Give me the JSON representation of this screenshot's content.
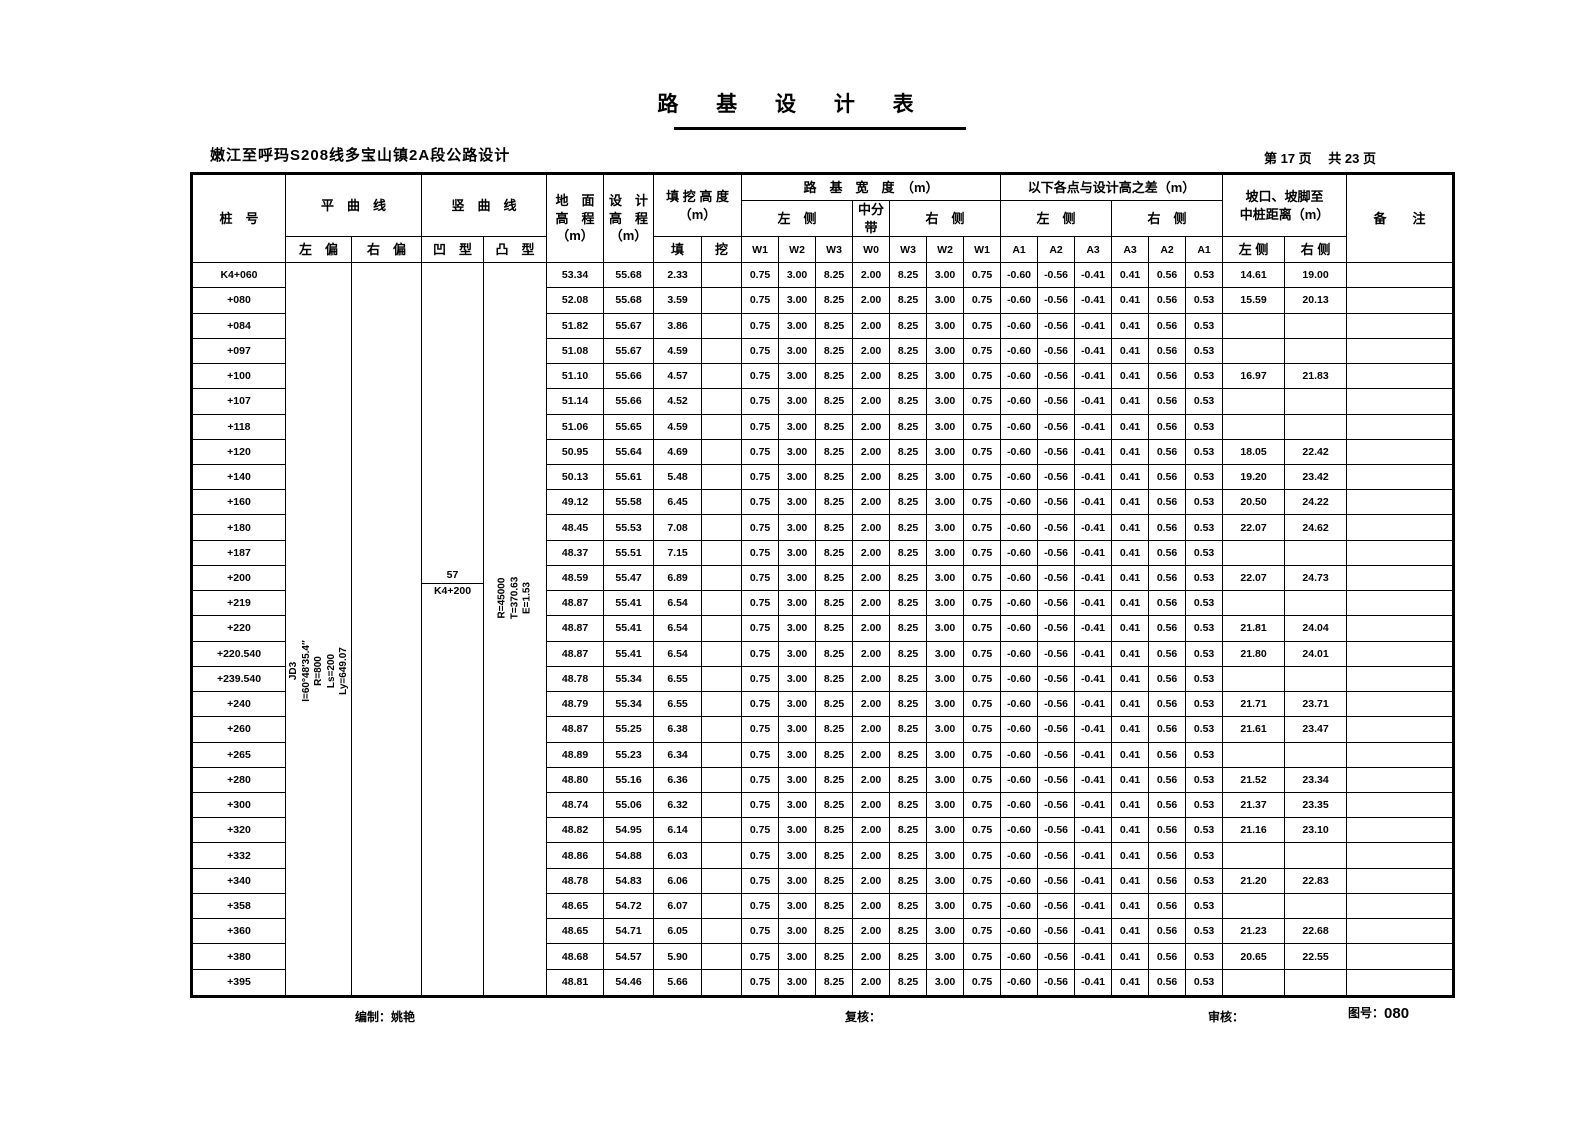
{
  "title": "路 基 设 计 表",
  "subtitle": "嫩江至呼玛S208线多宝山镇2A段公路设计",
  "page_info": "第 17 页　 共 23 页",
  "colors": {
    "line": "#000000",
    "background": "#ffffff"
  },
  "header": {
    "stake": "桩　号",
    "hcurve": {
      "title": "平　曲　线",
      "left": "左　偏",
      "right": "右　偏"
    },
    "vcurve": {
      "title": "竖　曲　线",
      "concave": "凹　型",
      "convex": "凸　型"
    },
    "ground": {
      "l1": "地　面",
      "l2": "高　程",
      "l3": "（m）"
    },
    "design": {
      "l1": "设　计",
      "l2": "高　程",
      "l3": "（m）"
    },
    "cutfill": {
      "title": "填 挖 高 度",
      "unit": "（m）",
      "fill": "填",
      "cut": "挖"
    },
    "width": {
      "title": "路　基　宽　度　（m）",
      "left": "左　侧",
      "median": "中分带",
      "right": "右　侧",
      "cols": [
        "W1",
        "W2",
        "W3",
        "W0",
        "W3",
        "W2",
        "W1"
      ]
    },
    "diff": {
      "title": "以下各点与设计高之差（m）",
      "left": "左　侧",
      "right": "右　侧",
      "cols": [
        "A1",
        "A2",
        "A3",
        "A3",
        "A2",
        "A1"
      ]
    },
    "slope": {
      "l1": "坡口、坡脚至",
      "l2": "中桩距离（m）",
      "left": "左 侧",
      "right": "右 侧"
    },
    "remark": "备　　注"
  },
  "annotations": {
    "h_curve_left": [
      "JD3",
      "I=60°48′35.4″",
      "R=800",
      "Ls=200",
      "Ly=649.07"
    ],
    "v_curve_concave": {
      "top": "57",
      "bottom": "K4+200"
    },
    "v_curve_convex": [
      "R=45000",
      "T=370.63",
      "E=1.53"
    ]
  },
  "constants": {
    "w_values": [
      "0.75",
      "3.00",
      "8.25",
      "2.00",
      "8.25",
      "3.00",
      "0.75"
    ],
    "a_values": [
      "-0.60",
      "-0.56",
      "-0.41",
      "0.41",
      "0.56",
      "0.53"
    ]
  },
  "rows": [
    {
      "stake": "K4+060",
      "ground": "53.34",
      "design": "55.68",
      "fill": "2.33",
      "cut": "",
      "dist_left": "14.61",
      "dist_right": "19.00"
    },
    {
      "stake": "+080",
      "ground": "52.08",
      "design": "55.68",
      "fill": "3.59",
      "cut": "",
      "dist_left": "15.59",
      "dist_right": "20.13"
    },
    {
      "stake": "+084",
      "ground": "51.82",
      "design": "55.67",
      "fill": "3.86",
      "cut": "",
      "dist_left": "",
      "dist_right": ""
    },
    {
      "stake": "+097",
      "ground": "51.08",
      "design": "55.67",
      "fill": "4.59",
      "cut": "",
      "dist_left": "",
      "dist_right": ""
    },
    {
      "stake": "+100",
      "ground": "51.10",
      "design": "55.66",
      "fill": "4.57",
      "cut": "",
      "dist_left": "16.97",
      "dist_right": "21.83"
    },
    {
      "stake": "+107",
      "ground": "51.14",
      "design": "55.66",
      "fill": "4.52",
      "cut": "",
      "dist_left": "",
      "dist_right": ""
    },
    {
      "stake": "+118",
      "ground": "51.06",
      "design": "55.65",
      "fill": "4.59",
      "cut": "",
      "dist_left": "",
      "dist_right": ""
    },
    {
      "stake": "+120",
      "ground": "50.95",
      "design": "55.64",
      "fill": "4.69",
      "cut": "",
      "dist_left": "18.05",
      "dist_right": "22.42"
    },
    {
      "stake": "+140",
      "ground": "50.13",
      "design": "55.61",
      "fill": "5.48",
      "cut": "",
      "dist_left": "19.20",
      "dist_right": "23.42"
    },
    {
      "stake": "+160",
      "ground": "49.12",
      "design": "55.58",
      "fill": "6.45",
      "cut": "",
      "dist_left": "20.50",
      "dist_right": "24.22"
    },
    {
      "stake": "+180",
      "ground": "48.45",
      "design": "55.53",
      "fill": "7.08",
      "cut": "",
      "dist_left": "22.07",
      "dist_right": "24.62"
    },
    {
      "stake": "+187",
      "ground": "48.37",
      "design": "55.51",
      "fill": "7.15",
      "cut": "",
      "dist_left": "",
      "dist_right": ""
    },
    {
      "stake": "+200",
      "ground": "48.59",
      "design": "55.47",
      "fill": "6.89",
      "cut": "",
      "dist_left": "22.07",
      "dist_right": "24.73"
    },
    {
      "stake": "+219",
      "ground": "48.87",
      "design": "55.41",
      "fill": "6.54",
      "cut": "",
      "dist_left": "",
      "dist_right": ""
    },
    {
      "stake": "+220",
      "ground": "48.87",
      "design": "55.41",
      "fill": "6.54",
      "cut": "",
      "dist_left": "21.81",
      "dist_right": "24.04"
    },
    {
      "stake": "+220.540",
      "ground": "48.87",
      "design": "55.41",
      "fill": "6.54",
      "cut": "",
      "dist_left": "21.80",
      "dist_right": "24.01"
    },
    {
      "stake": "+239.540",
      "ground": "48.78",
      "design": "55.34",
      "fill": "6.55",
      "cut": "",
      "dist_left": "",
      "dist_right": ""
    },
    {
      "stake": "+240",
      "ground": "48.79",
      "design": "55.34",
      "fill": "6.55",
      "cut": "",
      "dist_left": "21.71",
      "dist_right": "23.71"
    },
    {
      "stake": "+260",
      "ground": "48.87",
      "design": "55.25",
      "fill": "6.38",
      "cut": "",
      "dist_left": "21.61",
      "dist_right": "23.47"
    },
    {
      "stake": "+265",
      "ground": "48.89",
      "design": "55.23",
      "fill": "6.34",
      "cut": "",
      "dist_left": "",
      "dist_right": ""
    },
    {
      "stake": "+280",
      "ground": "48.80",
      "design": "55.16",
      "fill": "6.36",
      "cut": "",
      "dist_left": "21.52",
      "dist_right": "23.34"
    },
    {
      "stake": "+300",
      "ground": "48.74",
      "design": "55.06",
      "fill": "6.32",
      "cut": "",
      "dist_left": "21.37",
      "dist_right": "23.35"
    },
    {
      "stake": "+320",
      "ground": "48.82",
      "design": "54.95",
      "fill": "6.14",
      "cut": "",
      "dist_left": "21.16",
      "dist_right": "23.10"
    },
    {
      "stake": "+332",
      "ground": "48.86",
      "design": "54.88",
      "fill": "6.03",
      "cut": "",
      "dist_left": "",
      "dist_right": ""
    },
    {
      "stake": "+340",
      "ground": "48.78",
      "design": "54.83",
      "fill": "6.06",
      "cut": "",
      "dist_left": "21.20",
      "dist_right": "22.83"
    },
    {
      "stake": "+358",
      "ground": "48.65",
      "design": "54.72",
      "fill": "6.07",
      "cut": "",
      "dist_left": "",
      "dist_right": ""
    },
    {
      "stake": "+360",
      "ground": "48.65",
      "design": "54.71",
      "fill": "6.05",
      "cut": "",
      "dist_left": "21.23",
      "dist_right": "22.68"
    },
    {
      "stake": "+380",
      "ground": "48.68",
      "design": "54.57",
      "fill": "5.90",
      "cut": "",
      "dist_left": "20.65",
      "dist_right": "22.55"
    },
    {
      "stake": "+395",
      "ground": "48.81",
      "design": "54.46",
      "fill": "5.66",
      "cut": "",
      "dist_left": "",
      "dist_right": ""
    }
  ],
  "footer": {
    "prepared_label": "编制：",
    "prepared_by": "姚艳",
    "check_label": "复核：",
    "review_label": "审核：",
    "drawing_label": "图号：",
    "drawing_no": "080"
  }
}
